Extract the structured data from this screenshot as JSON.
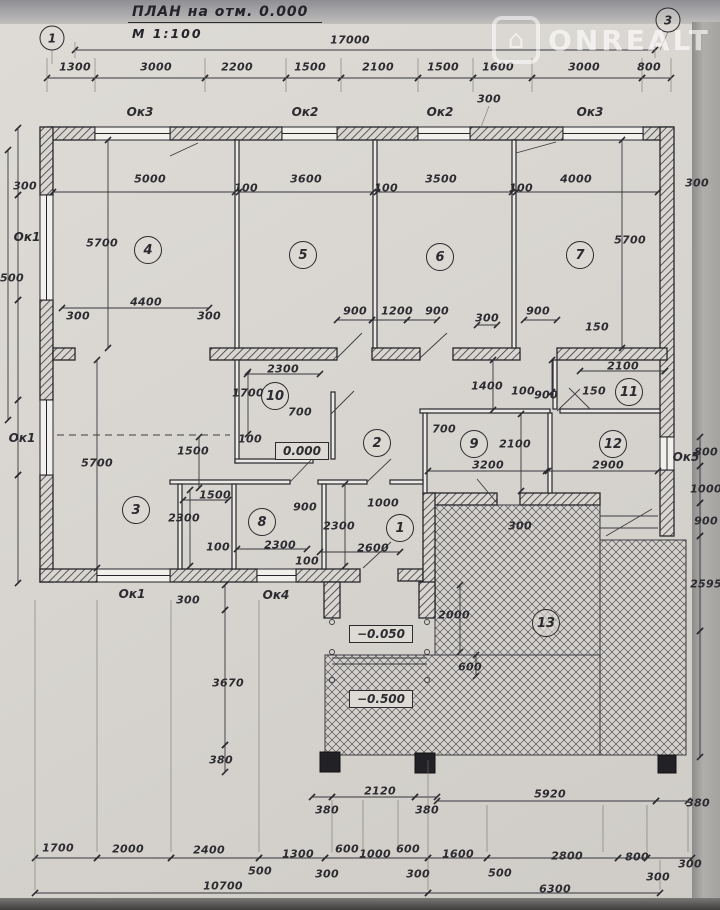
{
  "title": {
    "text": "ПЛАН на отм. 0.000",
    "scale": "М 1:100"
  },
  "watermark": {
    "text": "ONREALT",
    "logo": "house-icon"
  },
  "colors": {
    "paper": "#d8d5d0",
    "ink": "#2b2b30"
  },
  "axis_markers": [
    {
      "label": "1",
      "x": 52,
      "y": 38
    },
    {
      "label": "3",
      "x": 668,
      "y": 20
    }
  ],
  "room_numbers": [
    {
      "n": "4",
      "x": 148,
      "y": 250
    },
    {
      "n": "5",
      "x": 303,
      "y": 255
    },
    {
      "n": "6",
      "x": 440,
      "y": 257
    },
    {
      "n": "7",
      "x": 580,
      "y": 255
    },
    {
      "n": "10",
      "x": 275,
      "y": 396
    },
    {
      "n": "2",
      "x": 377,
      "y": 443
    },
    {
      "n": "9",
      "x": 474,
      "y": 444
    },
    {
      "n": "11",
      "x": 629,
      "y": 392
    },
    {
      "n": "12",
      "x": 613,
      "y": 444
    },
    {
      "n": "3",
      "x": 136,
      "y": 510
    },
    {
      "n": "8",
      "x": 262,
      "y": 522
    },
    {
      "n": "1",
      "x": 400,
      "y": 528
    },
    {
      "n": "13",
      "x": 546,
      "y": 623
    }
  ],
  "level_marks": [
    {
      "t": "0.000",
      "x": 302,
      "y": 451
    },
    {
      "t": "−0.050",
      "x": 381,
      "y": 634
    },
    {
      "t": "−0.500",
      "x": 381,
      "y": 699
    }
  ],
  "window_labels": [
    {
      "t": "Ок3",
      "x": 140,
      "y": 112
    },
    {
      "t": "Ок2",
      "x": 305,
      "y": 112
    },
    {
      "t": "Ок2",
      "x": 440,
      "y": 112
    },
    {
      "t": "Ок3",
      "x": 590,
      "y": 112
    },
    {
      "t": "Ок1",
      "x": 27,
      "y": 237
    },
    {
      "t": "Ок1",
      "x": 22,
      "y": 438
    },
    {
      "t": "Ок1",
      "x": 132,
      "y": 594
    },
    {
      "t": "Ок4",
      "x": 276,
      "y": 595
    },
    {
      "t": "Ок5",
      "x": 686,
      "y": 457
    }
  ],
  "dimensions": [
    {
      "t": "17000",
      "x": 350,
      "y": 40
    },
    {
      "t": "1300",
      "x": 75,
      "y": 67
    },
    {
      "t": "3000",
      "x": 156,
      "y": 67
    },
    {
      "t": "2200",
      "x": 237,
      "y": 67
    },
    {
      "t": "1500",
      "x": 310,
      "y": 67
    },
    {
      "t": "2100",
      "x": 378,
      "y": 67
    },
    {
      "t": "1500",
      "x": 443,
      "y": 67
    },
    {
      "t": "1600",
      "x": 498,
      "y": 67
    },
    {
      "t": "3000",
      "x": 584,
      "y": 67
    },
    {
      "t": "800",
      "x": 649,
      "y": 67
    },
    {
      "t": "300",
      "x": 489,
      "y": 99,
      "r": 1
    },
    {
      "t": "300",
      "x": 25,
      "y": 186
    },
    {
      "t": "5000",
      "x": 150,
      "y": 179
    },
    {
      "t": "100",
      "x": 246,
      "y": 188
    },
    {
      "t": "3600",
      "x": 306,
      "y": 179
    },
    {
      "t": "100",
      "x": 386,
      "y": 188
    },
    {
      "t": "3500",
      "x": 441,
      "y": 179
    },
    {
      "t": "100",
      "x": 521,
      "y": 188
    },
    {
      "t": "4000",
      "x": 576,
      "y": 179
    },
    {
      "t": "300",
      "x": 697,
      "y": 183
    },
    {
      "t": "5700",
      "x": 102,
      "y": 243,
      "r": 1
    },
    {
      "t": "5700",
      "x": 630,
      "y": 240,
      "r": 1
    },
    {
      "t": "7500",
      "x": 8,
      "y": 278,
      "r": 1
    },
    {
      "t": "4400",
      "x": 146,
      "y": 302
    },
    {
      "t": "300",
      "x": 78,
      "y": 316
    },
    {
      "t": "300",
      "x": 209,
      "y": 316
    },
    {
      "t": "900",
      "x": 355,
      "y": 311
    },
    {
      "t": "1200",
      "x": 397,
      "y": 311
    },
    {
      "t": "900",
      "x": 437,
      "y": 311
    },
    {
      "t": "300",
      "x": 487,
      "y": 318
    },
    {
      "t": "900",
      "x": 538,
      "y": 311
    },
    {
      "t": "150",
      "x": 597,
      "y": 327,
      "r": 1
    },
    {
      "t": "2300",
      "x": 283,
      "y": 369
    },
    {
      "t": "2100",
      "x": 623,
      "y": 366
    },
    {
      "t": "150",
      "x": 594,
      "y": 391,
      "r": 1
    },
    {
      "t": "900",
      "x": 546,
      "y": 395,
      "r": 1
    },
    {
      "t": "1700",
      "x": 248,
      "y": 393,
      "r": 1
    },
    {
      "t": "700",
      "x": 300,
      "y": 412,
      "r": 1
    },
    {
      "t": "100",
      "x": 250,
      "y": 439,
      "r": 1
    },
    {
      "t": "1400",
      "x": 487,
      "y": 386,
      "r": 1
    },
    {
      "t": "100",
      "x": 523,
      "y": 391,
      "r": 1
    },
    {
      "t": "1500",
      "x": 193,
      "y": 451,
      "r": 1
    },
    {
      "t": "1500",
      "x": 215,
      "y": 495
    },
    {
      "t": "700",
      "x": 444,
      "y": 429,
      "r": 1
    },
    {
      "t": "2100",
      "x": 515,
      "y": 444,
      "r": 1
    },
    {
      "t": "3200",
      "x": 488,
      "y": 465
    },
    {
      "t": "2900",
      "x": 608,
      "y": 465
    },
    {
      "t": "800",
      "x": 706,
      "y": 452,
      "r": 1
    },
    {
      "t": "1000",
      "x": 706,
      "y": 489,
      "r": 1
    },
    {
      "t": "900",
      "x": 706,
      "y": 521,
      "r": 1
    },
    {
      "t": "2595",
      "x": 706,
      "y": 584,
      "r": 1
    },
    {
      "t": "5700",
      "x": 97,
      "y": 463,
      "r": 1
    },
    {
      "t": "2300",
      "x": 184,
      "y": 518,
      "r": 1
    },
    {
      "t": "100",
      "x": 218,
      "y": 547
    },
    {
      "t": "2300",
      "x": 280,
      "y": 545
    },
    {
      "t": "900",
      "x": 305,
      "y": 507
    },
    {
      "t": "2300",
      "x": 339,
      "y": 526,
      "r": 1
    },
    {
      "t": "1000",
      "x": 383,
      "y": 503
    },
    {
      "t": "2600",
      "x": 373,
      "y": 548
    },
    {
      "t": "100",
      "x": 307,
      "y": 561
    },
    {
      "t": "300",
      "x": 188,
      "y": 600,
      "r": 1
    },
    {
      "t": "300",
      "x": 520,
      "y": 526,
      "r": 1
    },
    {
      "t": "2000",
      "x": 454,
      "y": 615,
      "r": 1
    },
    {
      "t": "600",
      "x": 470,
      "y": 667,
      "r": 1
    },
    {
      "t": "3670",
      "x": 228,
      "y": 683,
      "r": 1
    },
    {
      "t": "380",
      "x": 221,
      "y": 760,
      "r": 1
    },
    {
      "t": "2120",
      "x": 380,
      "y": 791
    },
    {
      "t": "380",
      "x": 327,
      "y": 810
    },
    {
      "t": "380",
      "x": 427,
      "y": 810
    },
    {
      "t": "5920",
      "x": 550,
      "y": 794
    },
    {
      "t": "380",
      "x": 698,
      "y": 803
    },
    {
      "t": "1700",
      "x": 58,
      "y": 848
    },
    {
      "t": "2000",
      "x": 128,
      "y": 849
    },
    {
      "t": "2400",
      "x": 209,
      "y": 850
    },
    {
      "t": "500",
      "x": 260,
      "y": 871
    },
    {
      "t": "1300",
      "x": 298,
      "y": 854
    },
    {
      "t": "600",
      "x": 347,
      "y": 849
    },
    {
      "t": "300",
      "x": 327,
      "y": 874
    },
    {
      "t": "1000",
      "x": 375,
      "y": 854
    },
    {
      "t": "600",
      "x": 408,
      "y": 849
    },
    {
      "t": "300",
      "x": 418,
      "y": 874
    },
    {
      "t": "1600",
      "x": 458,
      "y": 854
    },
    {
      "t": "500",
      "x": 500,
      "y": 873
    },
    {
      "t": "2800",
      "x": 567,
      "y": 856
    },
    {
      "t": "800",
      "x": 637,
      "y": 857
    },
    {
      "t": "300",
      "x": 690,
      "y": 864
    },
    {
      "t": "300",
      "x": 658,
      "y": 877
    },
    {
      "t": "10700",
      "x": 223,
      "y": 886
    },
    {
      "t": "6300",
      "x": 555,
      "y": 889
    }
  ]
}
